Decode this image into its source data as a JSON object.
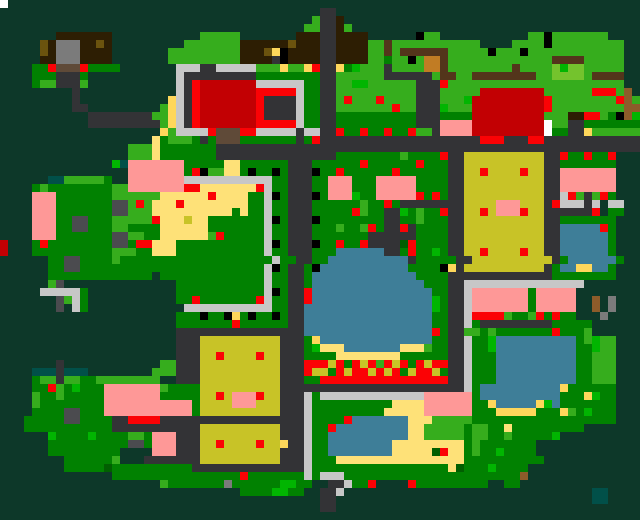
{
  "map": {
    "cols": 80,
    "rows": 65,
    "cell_px": 8,
    "palette": {
      ".": {
        "hex": "#0d3829",
        "name": "forest-background"
      },
      "g": {
        "hex": "#018101",
        "name": "grass"
      },
      "G": {
        "hex": "#36ad1d",
        "name": "bright-grass"
      },
      "E": {
        "hex": "#01b501",
        "name": "vivid-bush"
      },
      "d": {
        "hex": "#015f01",
        "name": "dark-bush"
      },
      "L": {
        "hex": "#74c32d",
        "name": "light-meadow"
      },
      "p": {
        "hex": "#333336",
        "name": "path-road"
      },
      "P": {
        "hex": "#4b4b4f",
        "name": "rock"
      },
      "s": {
        "hex": "#c7c7c7",
        "name": "silver-fence"
      },
      "h": {
        "hex": "#7b7b7b",
        "name": "stone"
      },
      "W": {
        "hex": "#ffffff",
        "name": "white-marker"
      },
      "k": {
        "hex": "#000000",
        "name": "black-marker"
      },
      "b": {
        "hex": "#2d1e03",
        "name": "dark-roof"
      },
      "B": {
        "hex": "#5f4a38",
        "name": "door"
      },
      "n": {
        "hex": "#53351b",
        "name": "wood-fence"
      },
      "N": {
        "hex": "#c17c24",
        "name": "crate"
      },
      "M": {
        "hex": "#8d5c2a",
        "name": "light-wood"
      },
      "o": {
        "hex": "#6b530e",
        "name": "dark-gold"
      },
      "r": {
        "hex": "#fb0205",
        "name": "red-flower"
      },
      "R": {
        "hex": "#c20003",
        "name": "red-roof"
      },
      "q": {
        "hex": "#fe9897",
        "name": "pink-house"
      },
      "y": {
        "hex": "#fee178",
        "name": "sand"
      },
      "Y": {
        "hex": "#fed75b",
        "name": "gold-item"
      },
      "f": {
        "hex": "#c8c327",
        "name": "crop-field"
      },
      "w": {
        "hex": "#3e7e98",
        "name": "water"
      },
      "t": {
        "hex": "#015049",
        "name": "teal-structure"
      }
    },
    "grid": [
      "W...............................................................................",
      "........................................pp......................................",
      ".......................................Gppb.....................................",
      "......................................GGppbG....................................",
      ".......bbbbbbb...........GGGGG.......bbbppbbbb......kGG...........GGkGGGGGGG....",
      ".....obhhhbbob.........GGGGGGGbbbbbbobbbppbbbbGGnGGGGGGGGGGG....GGGGkGGGGGGGGG..",
      ".....obhhhbbbb.......GGGGGGGGGbbboYkbbbbppbbbbGGnGnnnnnnGGGGGkGGGkGGGGGGGGGGGG..",
      ".....bbhhhbbbb.......GGGGGGGGGbbbbpkbbbbppbbbbGGgGGkGNNnGGGGGGGGGGGGGnnnnGGGGG..",
      "....ggrBBBrgggg.......sssppsssssGGGYGGYrppYgEGGGpGGGGNNnGGGGGGGGnGGGGLELLGGGGG..",
      "....gggpppg...........spppppppppggggggggppGGGGGGppppppGnnGGnnnnnnnnGGLLLLGnnnn..",
      "....gGGpppG...........sprRRRRRRRssssssggppGGEEGGGGGGppprGGGGGGGGGGGGGGGGGGGGGG..",
      ".........p............sprRRRRRRRrrrrrsggppGGGGGGGGGGpppGGGGGRRRRRRRRGGGGGGrrrGM.",
      ".........p...........YsprRRRRRRRrppppsggppGrGGGrGGGGpppGGGERRRRRRRRRrGGGGGGGGrMG",
      ".........pp.........GYsprRRRRRRRrppppsggppGGGGGGGrGGpppEGGGRRRRRRRRRrGGGGGGGGGMM",
      "...........ppppppppGGYsprRRRRRRRrppppsggppggggggggggpppggggRRRRRRRRRGGGbbrrGgkME",
      "...........pppppppppGYsprRRRRRRRrrrrrsggppggggggggggpppqqqqRRRRRRRRRWGGppggggggg",
      "....................YGssssrBBBrrssssspsspprggrggrggrGGpqqqqRRRRRRRRRWggppYGGGGGG",
      "...................ygGGGgpgBBBgggggggpgrpppppppppppppppppppprrrppprrpppppppppppp",
      "................GGGygggggggppppppppppppppppppppppppppppppppppppppppppppppppppppp",
      "................GGGygggggggpppppppppppppppggggggggGggggrppffffffffffpprggrggr...",
      "..............Etqqqqqqqgggggyyggggggpppggggggrggggggrgggppffffffffffppggggggg...",
      "................qqqqqqqgrkGGyygkggkgpppkggrggggggrggggggppffrffffrffppqqqqqqq...",
      "......ttGGGGGg..qqqqqqqsssssssssssggpppggqqqgggqqqqqggggppffffffffffppqqqqqqq...",
      "....gGggggggggGGqqqqqqqrryyyyyyyrsggpppggqqqgggqqqqqggggppffffffffffppqqqqqqq...",
      "....qqqgggggggGGGGGGyyyyyyryyyyggskgpppkgqqqEggqqqqqrgrgppffffffffffppsrGpGrg...",
      "....qqqgggggggPPGrGyyyryyyyyyyyggsggpppggggggGggrgppppppppffffqqqfffprsssps ss...",
      "....qqqgggggggPPGGGyyyyyyyyyygyggsggpppgggggrGggppEgGggrppffrfqqqrffppppppr gg...",
      "....qqqggPPgggGGGGGryyyfyygggggggskgpppkggggggggppggGgggppffffffffffppggggggg...",
      "....qqqggPPgggGGggggyyyyyygggggggsggpppgggGggGrgpprpggggppffffffffffppwwwwwrg...",
      "....qqqgggggggPPGGggyyyyyyGrgggggsggpppgggggggppppppggggppffffffffffppwwwwwwg...",
      "R...grggggggggPPgrryyygggggggggggskgpppkggrggrppppdrggggppffffffffffppwwwwwwg...",
      "R...ggggggggggGGGggyyygggggggggggsggpppgggwwwwwwppgrggEgppffrffffrffppwwwwwwg...",
      "......ggPPggggGgggggggggggggggggggsggppggwwwwwwwwwwpgggggppffffffffffpgwwwwwwg..",
      "......ggPPgggggggggggggggggggggggskgppgkwwwwwwwwwwwggggkYpffffffffffpgwwYYwwg...",
      "......ggggggggggggg.gggggggggggggsggppgwwwwwwwwwwwwwggggpppppppppppppgggggggg...",
      "......GP..............gggggggggggsggppgwwwwwwwwwwwwwwgggppsssssssssssssss.......",
      ".....sssssg...........gggggggggggskgpprwwwwwwwwwwwwwwwggppsqqqqqqqgqqqqq........",
      ".......PGsg...........ggrgggggggrsggpprwwwwwwwwwwwwwwwEgppsqqqqqqqgqqqqq..M.h...",
      ".......P.sg............sssssssssssggppwwwwwwwwwwwwwwwwEgppsqqqqqqqgqqqqq..M.h...",
      "......................gggkggkYgkggkgppwwwwwwwwwwwwwwwwggppsrrrrGggGrgrgg...h....",
      "......................gggggggrggggggppwwwwwwwwwwwwwwwwggppsgpppppppppggggg.....",
      "......................ppppppppppppppppwwwwwwwwwwwwwwwwrgppGGgGgggggggrgggG.....",
      "......................pppffffffffffpppgYwwwwwwwwwwwwwwggppsggEwwwwwwwwwwgGEGG...",
      "......................pppffffffffffpppgEyyywwwwwwwyyyGggppsggEwwwwwwwwwwggEGG...",
      "......................pppffrffffrffpppggggyyyyyyyyggggggppsgggwwwwwwwwwwggGGG...",
      ".......p............GGpppffffffffffppprrrfrgrfrGrfrgrfrrppsgggwwwwwwwwwwggGGG...",
      "....tttpttt........GGGpppffffffffffppprffgrfrrfrfrgfrrfgppsgggwwwwwwwwwwggGGG...",
      "....gGGpGGggGGGGGGGG..pppffffffffffpppggrrrrrrrrrrrrrrrrppsgggwwwwwwwwwwggGGG...",
      "....ggrGgEgggqqqqqqqGggggffffffffffpppppppppppppppppppppppsgwwwwwwwwwwYgggggg...",
      "....GggGgggggqqqqqqqgggggffrfqqqrffpppsgsssssssssssssqqqqqqgwwwwwwwwwwgggYEgg...",
      "....GggggggggqqqqqqqqqqqgffffqqqfffpppsggggggggggyyyyqqqqqqggYwwwwwYEwggggggg...",
      "....ggggPPgggqqqqqqqqqqqgffffffffffpppsgggggggggyyyyyqqqqqqgggYYYYYgggYGgEggg...",
      "...gggggPPggggpprrrrppppppppppppppppppsggggrwwwwwwwyyyGGGGGgggggggggggggggggg...",
      "...gggggggggggpppppppppppffffffffffpppsggrwwwwwwwwwyyGGGGGgGGggyggggggggg......",
      "......EggggEggggGGgqqqpppffffffffffpppsggwwwwwwwwwwyyGGGGGgGGggGgggggE.........",
      "......ggggggggggPPgqqqpppffrffffrffYppsggwwwwwwwwyyyyyyyyygGggggggg............",
      "......ggggggggg....qqqpppffffffffffpppsggwwwwwwwwyyyyydryygGggEgggg............",
      "........ggggggG...pppppppffffffffffpppsgggyyyyyyyyyyyyyyyygggggggggg............",
      "........gggggdggggggggggppppppppppppppsgggggggggggggggggydgggEgggg..............",
      "..............ggggggggggggggggrgggggggsgsssggggggggggggggggggggggM..............",
      "....................GggggggghggggggEEgg..ppsggr....rggggggggg..gg................",
      "..............................ggggEEgg..pps...............................tt....",
      "........................................pp................................tt....",
      "........................................pp......................................",
      "................................................................................"
    ]
  }
}
